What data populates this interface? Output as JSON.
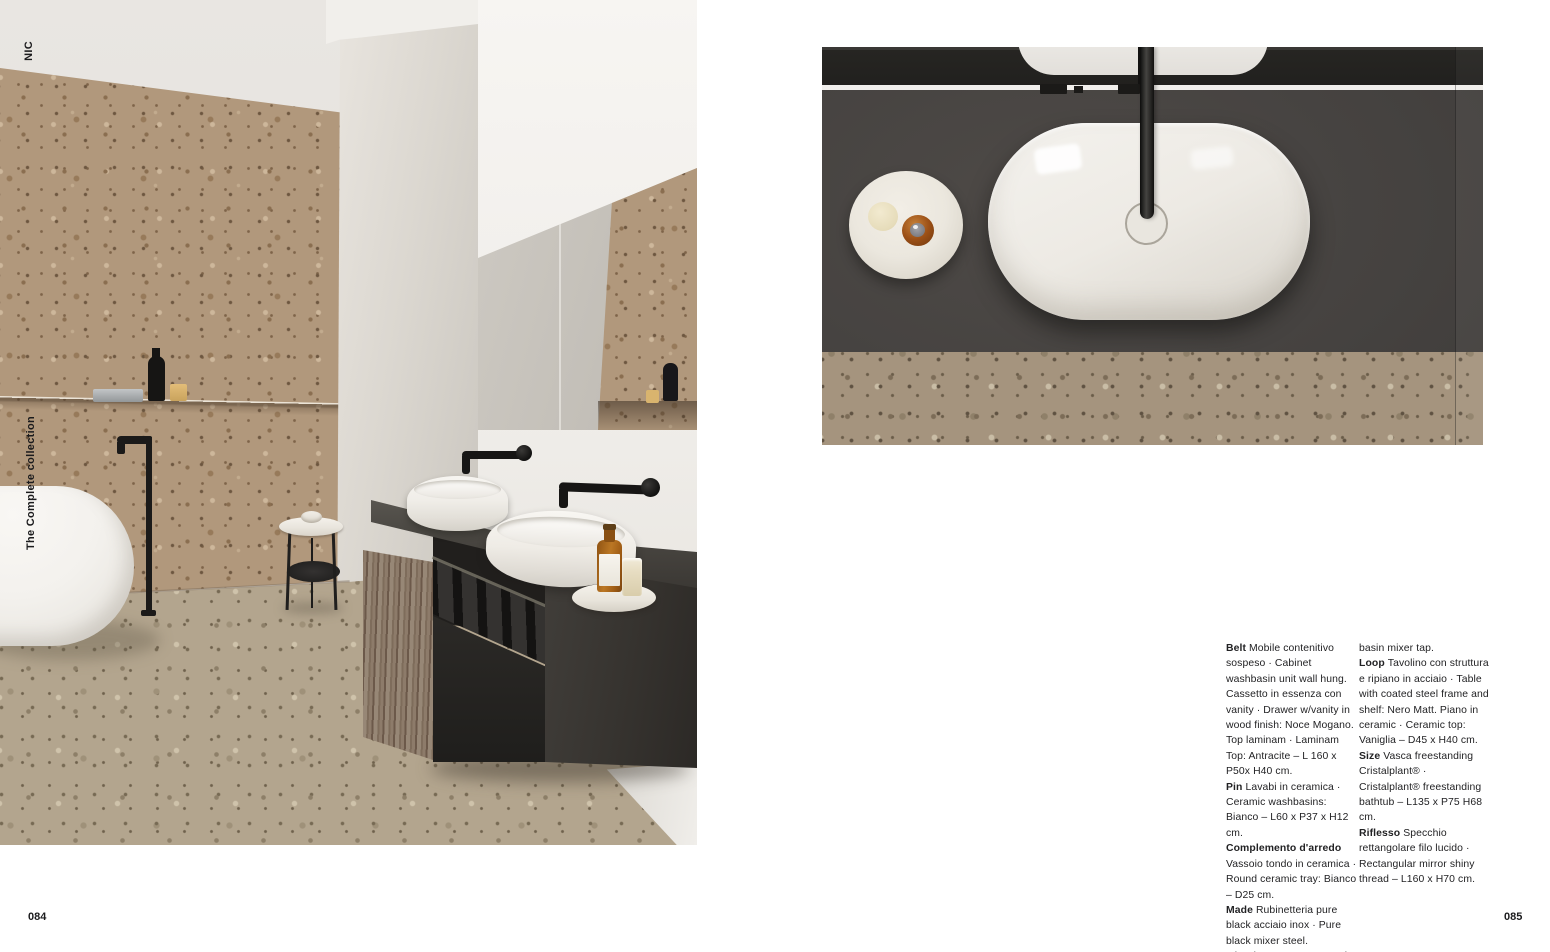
{
  "page": {
    "collection_code": "NIC",
    "collection_label": "The Complete collection",
    "left_page_number": "084",
    "right_page_number": "085"
  },
  "specs": {
    "column1": [
      {
        "name": "Belt",
        "text": "Mobile contenitivo sospeso · Cabinet washbasin unit wall hung. Cassetto in essenza con vanity · Drawer w/vanity in wood finish: Noce Mogano. Top laminam · Laminam Top: Antracite – L 160 x P50x  H40 cm."
      },
      {
        "name": "Pin",
        "text": "Lavabi in ceramica · Ceramic washbasins: Bianco – L60 x P37 x H12 cm."
      },
      {
        "name": "Complemento d'arredo",
        "text": "Vassoio tondo in ceramica · Round ceramic tray: Bianco – D25 cm."
      },
      {
        "name": "Made",
        "text": "Rubinetteria pure black acciaio inox · Pure black mixer steel. Miscelatore monocomando freestanding · Floor mounted"
      }
    ],
    "column2": [
      {
        "name": "",
        "text": "basin mixer tap."
      },
      {
        "name": "Loop",
        "text": "Tavolino con struttura e ripiano in acciaio · Table with coated steel frame and shelf: Nero Matt. Piano in ceramic · Ceramic top: Vaniglia – D45 x H40 cm."
      },
      {
        "name": "Size",
        "text": "Vasca freestanding Cristalplant® · Cristalplant® freestanding bathtub – L135 x P75 H68 cm."
      },
      {
        "name": "Riflesso",
        "text": "Specchio rettangolare filo lucido · Rectangular mirror shiny thread  – L160 x H70 cm."
      }
    ]
  },
  "colors": {
    "page_background": "#ffffff",
    "text": "#1b1b1d",
    "terrazzo_wall": "#b1987c",
    "terrazzo_floor": "#b3a58e",
    "counter_charcoal": "#43403d",
    "wood_drawer": "#85735f",
    "ceramic_white": "#f2efe9",
    "tap_black": "#171615",
    "amber_bottle": "#bb7724",
    "candle_gold": "#d9b46e"
  }
}
